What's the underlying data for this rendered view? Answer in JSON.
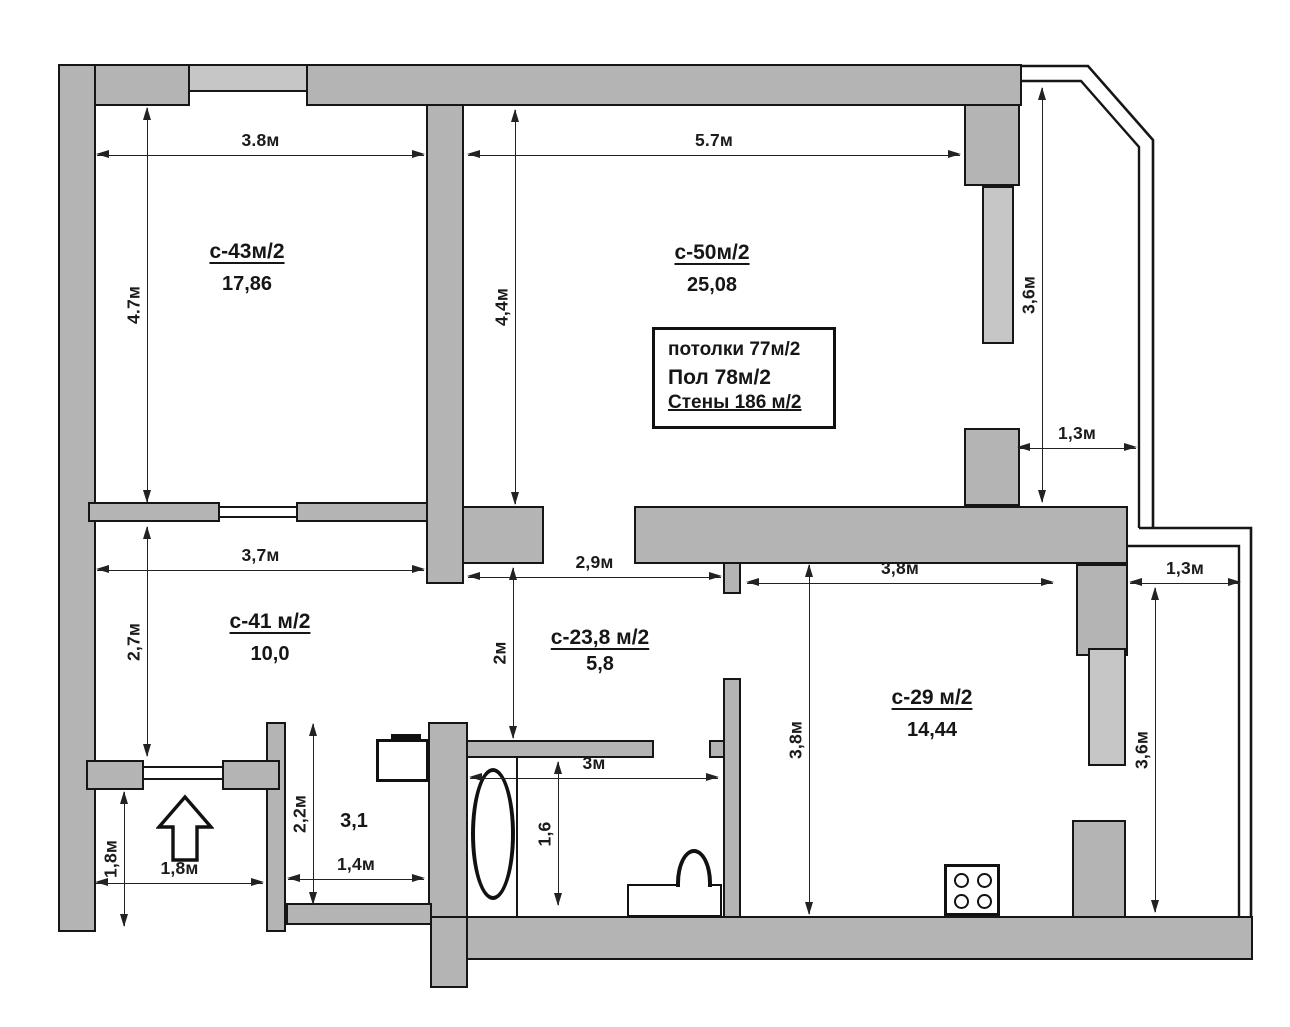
{
  "rooms": {
    "r43": {
      "label": "с-43м/2",
      "area": "17,86"
    },
    "r50": {
      "label": "с-50м/2",
      "area": "25,08"
    },
    "r41": {
      "label": "с-41 м/2",
      "area": "10,0"
    },
    "r238": {
      "label": "с-23,8 м/2",
      "area": "5,8"
    },
    "r29": {
      "label": "с-29 м/2",
      "area": "14,44"
    },
    "corridor": {
      "area": "3,1"
    }
  },
  "info_box": {
    "ceilings": "потолки 77м/2",
    "floor": "Пол 78м/2",
    "walls": "Стены 186 м/2"
  },
  "dims": {
    "d_r43_w": "3.8м",
    "d_r43_h": "4.7м",
    "d_r50_w": "5.7м",
    "d_r50_h": "4,4м",
    "d_balcony_h": "3,6м",
    "d_balcony_w": "1,3м",
    "d_r41_w": "3,7м",
    "d_r41_h": "2,7м",
    "d_hall_w": "2,9м",
    "d_hall_h": "2м",
    "d_r29_w": "3,8м",
    "d_r29_h": "3,8м",
    "d_loggia_w": "1,3м",
    "d_loggia_h": "3,6м",
    "d_vest_h": "1,8м",
    "d_vest_w": "1,8м",
    "d_corr_h": "2,2м",
    "d_corr_w": "1,4м",
    "d_bath_w": "3м",
    "d_bath_h": "1,6"
  },
  "colors": {
    "wall_fill": "#b4b4b4",
    "window_fill": "#c6c6c6",
    "outline": "#161616",
    "dim_line": "#222222"
  }
}
